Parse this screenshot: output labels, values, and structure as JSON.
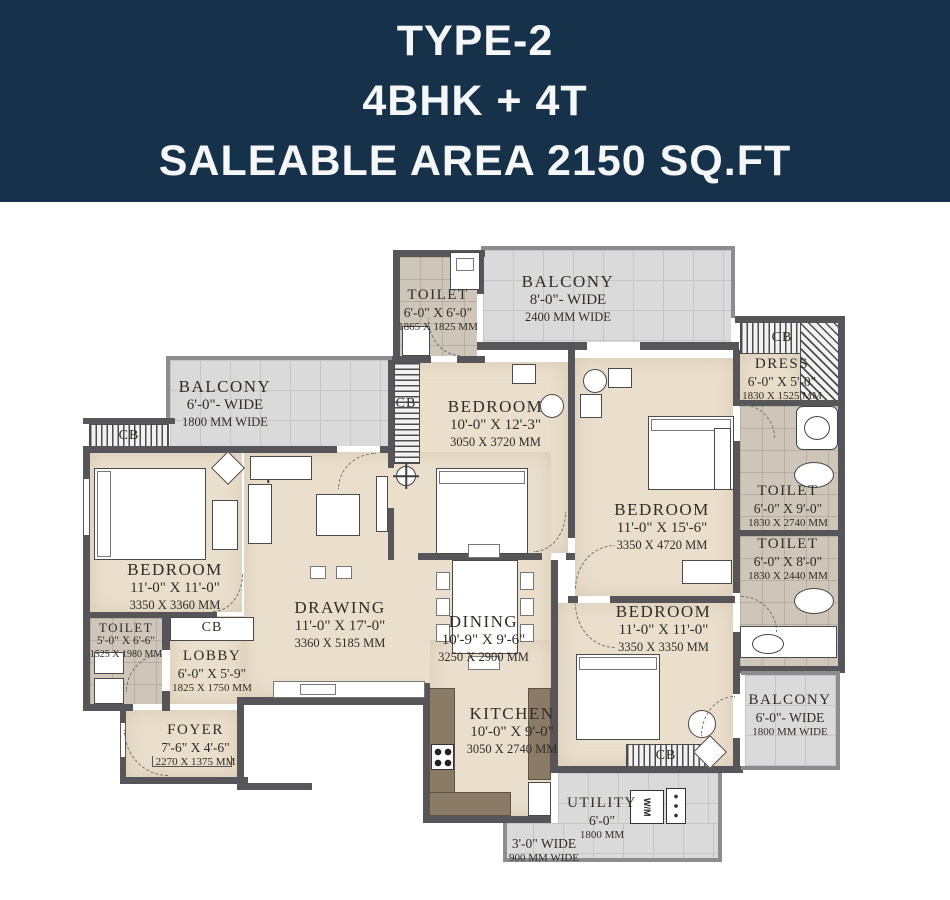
{
  "header": {
    "line1": "TYPE-2",
    "line2": "4BHK + 4T",
    "line3": "SALEABLE AREA 2150 SQ.FT",
    "bg_color": "#15324a",
    "text_color": "#f4f6f8"
  },
  "plan": {
    "cb_label": "CB",
    "wm_label": "W/M",
    "wall_color": "#55555a",
    "floor_color": "#eadfcc",
    "balcony_color": "#dadada",
    "toilet_color": "#cdc6b9",
    "counter_color": "#8a7a66",
    "rooms": [
      {
        "name": "TOILET",
        "dim_ft": "6'-0\" X 6'-0\"",
        "dim_mm": "1865 X 1825 MM"
      },
      {
        "name": "BALCONY",
        "dim_ft": "8'-0\"- WIDE",
        "dim_mm": "2400 MM WIDE"
      },
      {
        "name": "DRESS",
        "dim_ft": "6'-0\" X 5'-0\"",
        "dim_mm": "1830 X 1525 MM"
      },
      {
        "name": "BALCONY",
        "dim_ft": "6'-0\"- WIDE",
        "dim_mm": "1800 MM WIDE"
      },
      {
        "name": "BEDROOM",
        "dim_ft": "10'-0\" X 12'-3\"",
        "dim_mm": "3050 X 3720 MM"
      },
      {
        "name": "BEDROOM",
        "dim_ft": "11'-0\" X 15'-6\"",
        "dim_mm": "3350 X 4720 MM"
      },
      {
        "name": "TOILET",
        "dim_ft": "6'-0\" X 9'-0\"",
        "dim_mm": "1830 X 2740 MM"
      },
      {
        "name": "TOILET",
        "dim_ft": "6'-0\" X 8'-0\"",
        "dim_mm": "1830 X 2440 MM"
      },
      {
        "name": "BEDROOM",
        "dim_ft": "11'-0\" X 11'-0\"",
        "dim_mm": "3350 X 3360 MM"
      },
      {
        "name": "DRAWING",
        "dim_ft": "11'-0\" X 17'-0\"",
        "dim_mm": "3360 X 5185 MM"
      },
      {
        "name": "DINING",
        "dim_ft": "10'-9\" X 9'-6\"",
        "dim_mm": "3250 X 2900 MM"
      },
      {
        "name": "TOILET",
        "dim_ft": "5'-0\" X 6'-6\"",
        "dim_mm": "1525 X 1980 MM"
      },
      {
        "name": "LOBBY",
        "dim_ft": "6'-0\" X 5'-9\"",
        "dim_mm": "1825 X 1750 MM"
      },
      {
        "name": "FOYER",
        "dim_ft": "7'-6\" X 4'-6\"",
        "dim_mm": "2270 X 1375 MM"
      },
      {
        "name": "KITCHEN",
        "dim_ft": "10'-0\" X 9'-0\"",
        "dim_mm": "3050 X 2740 MM"
      },
      {
        "name": "BEDROOM",
        "dim_ft": "11'-0\" X 11'-0\"",
        "dim_mm": "3350 X 3350 MM"
      },
      {
        "name": "BALCONY",
        "dim_ft": "6'-0\"- WIDE",
        "dim_mm": "1800 MM WIDE"
      },
      {
        "name": "UTILITY",
        "dim_ft": "6'-0\"",
        "dim_mm": "1800 MM"
      },
      {
        "name": "",
        "dim_ft": "3'-0\" WIDE",
        "dim_mm": "900 MM WIDE"
      }
    ]
  }
}
